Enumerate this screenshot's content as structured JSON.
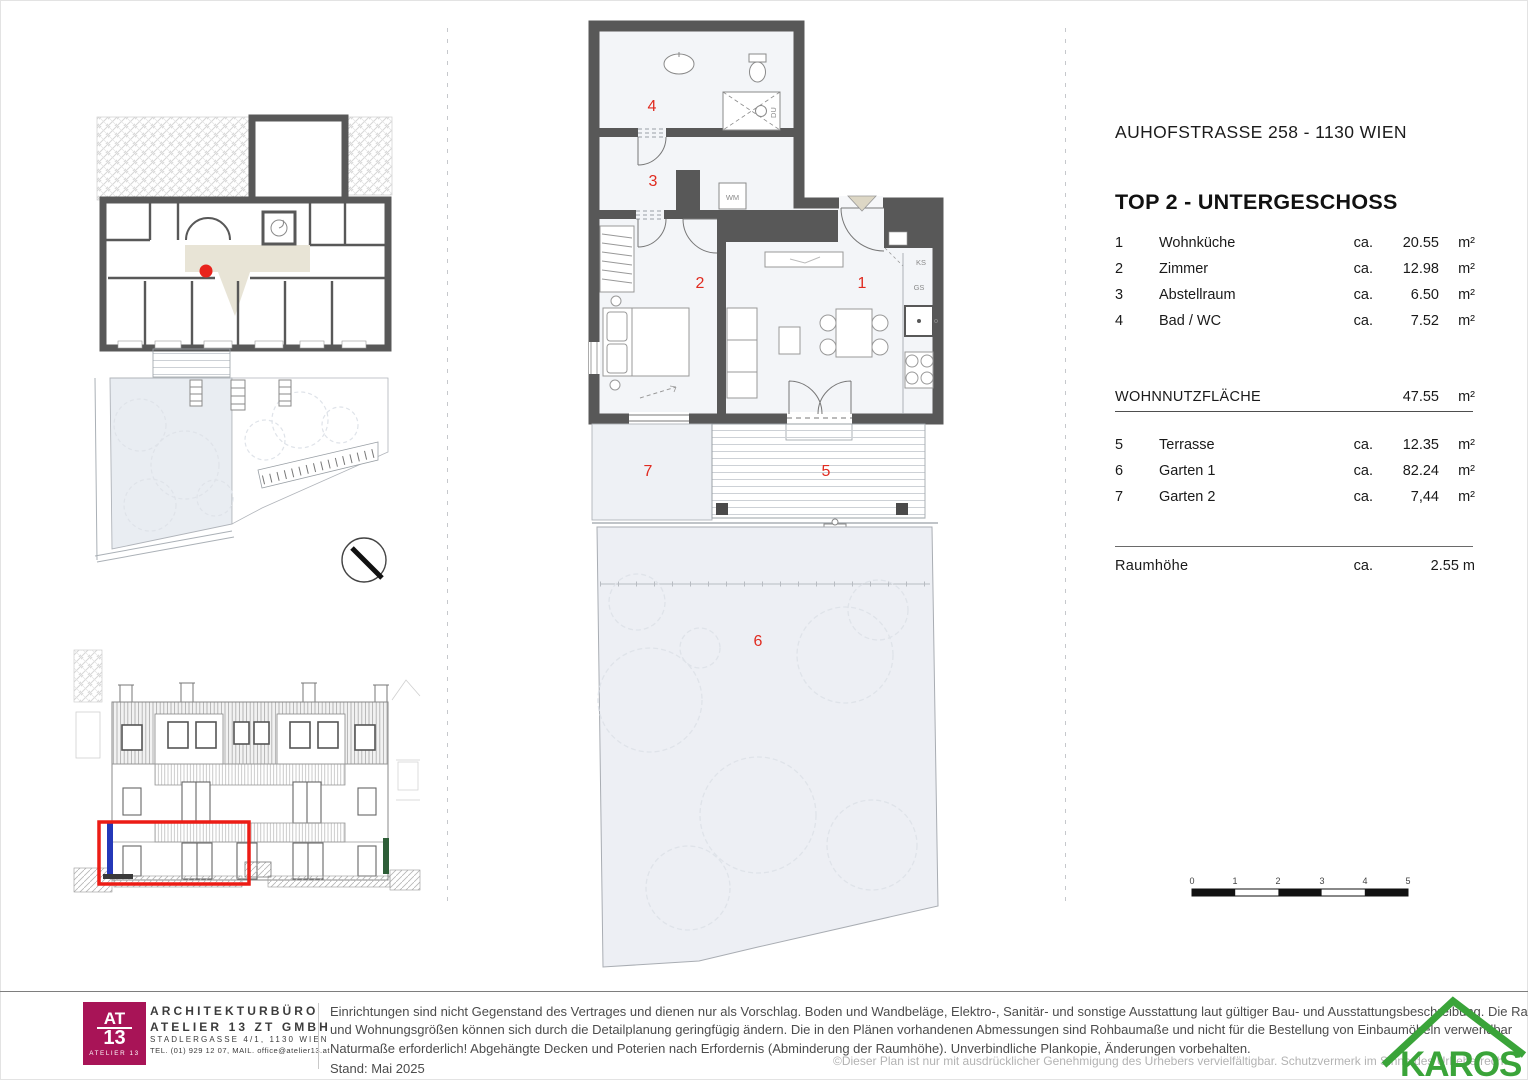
{
  "document": {
    "address": "AUHOFSTRASSE 258 - 1130 WIEN",
    "unit_title": "TOP 2  - UNTERGESCHOSS"
  },
  "area_table": {
    "interior_rows": [
      {
        "num": "1",
        "label": "Wohnküche",
        "ca": "ca.",
        "value": "20.55",
        "unit": "m²"
      },
      {
        "num": "2",
        "label": "Zimmer",
        "ca": "ca.",
        "value": "12.98",
        "unit": "m²"
      },
      {
        "num": "3",
        "label": "Abstellraum",
        "ca": "ca.",
        "value": "6.50",
        "unit": "m²"
      },
      {
        "num": "4",
        "label": "Bad / WC",
        "ca": "ca.",
        "value": "7.52",
        "unit": "m²"
      }
    ],
    "subtotal": {
      "label": "WOHNNUTZFLÄCHE",
      "value": "47.55",
      "unit": "m²"
    },
    "outdoor_rows": [
      {
        "num": "5",
        "label": "Terrasse",
        "ca": "ca.",
        "value": "12.35",
        "unit": "m²"
      },
      {
        "num": "6",
        "label": "Garten 1",
        "ca": "ca.",
        "value": "82.24",
        "unit": "m²"
      },
      {
        "num": "7",
        "label": "Garten 2",
        "ca": "ca.",
        "value": "7,44",
        "unit": "m²"
      }
    ],
    "room_height": {
      "label": "Raumhöhe",
      "ca": "ca.",
      "value": "2.55 m"
    }
  },
  "floor_plan": {
    "room_numbers": {
      "wohnkueche": "1",
      "zimmer": "2",
      "abstellraum": "3",
      "bad_wc": "4",
      "terrasse": "5",
      "garten1": "6",
      "garten2": "7"
    },
    "fixture_labels": {
      "shower": "DU",
      "washing_machine": "WM",
      "fridge": "KS",
      "dishwasher": "GS"
    }
  },
  "scale_bar": {
    "ticks": [
      "0",
      "1",
      "2",
      "3",
      "4",
      "5"
    ]
  },
  "footer": {
    "architect_logo": {
      "top": "AT",
      "middle": "13",
      "bottom": "ATELIER 13"
    },
    "architect": {
      "line1": "ARCHITEKTURBÜRO",
      "line2": "ATELIER 13 ZT GMBH",
      "line3": "STADLERGASSE 4/1, 1130 WIEN",
      "line4": "TEL. (01) 929 12 07, MAIL. office@atelier13.at"
    },
    "disclaimer_lines": [
      "Einrichtungen sind nicht Gegenstand des Vertrages und dienen nur als Vorschlag. Boden und Wandbeläge, Elektro-, Sanitär- und sonstige Ausstattung laut gültiger Bau- und Ausstattungsbeschreibung. Die Raum-",
      "und Wohnungsgrößen können sich durch die Detailplanung geringfügig ändern. Die in den Plänen vorhandenen Abmessungen sind Rohbaumaße und nicht für die Bestellung von Einbaumöbeln verwendbar",
      "Naturmaße erforderlich! Abgehängte Decken und Poterien nach Erfordernis (Abminderung der Raumhöhe). Unverbindliche Plankopie, Änderungen vorbehalten."
    ],
    "stand": "Stand:  Mai 2025",
    "copyright": "©Dieser Plan ist nur mit ausdrücklicher Genehmigung des Urhebers vervielfältigbar. Schutzvermerk im Sinne des Urheberrecht",
    "brand": "KAROS"
  },
  "colors": {
    "wall": "#585858",
    "floor": "#f3f5f8",
    "corridor_beige": "#e8e4d6",
    "garden_fill": "#edeff4",
    "plan_number_red": "#e02b20",
    "highlight_red": "#ec1c15",
    "architect_magenta": "#a81457",
    "brand_green": "#3aa439"
  }
}
